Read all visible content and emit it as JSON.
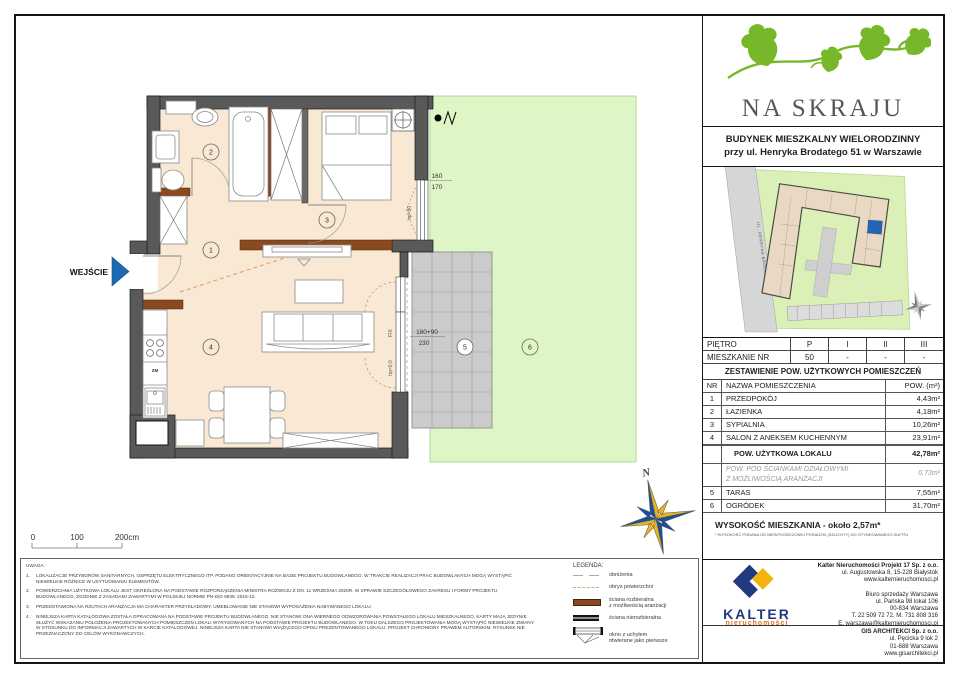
{
  "header": {
    "project_name": "NA SKRAJU",
    "building_line1": "BUDYNEK MIESZKALNY WIELORODZINNY",
    "building_line2": "przy ul. Henryka Brodatego 51 w Warszawie"
  },
  "site_plan": {
    "street_label": "UL. HENRYKA BRODATEGO"
  },
  "floor_table": {
    "floor_label": "PIĘTRO",
    "apartment_label": "MIESZKANIE NR",
    "columns": [
      "P",
      "I",
      "II",
      "III"
    ],
    "values": [
      "50",
      "-",
      "-",
      "-"
    ]
  },
  "area_table": {
    "title": "ZESTAWIENIE POW. UŻYTKOWYCH POMIESZCZEŃ",
    "col_nr": "NR",
    "col_name": "NAZWA POMIESZCZENIA",
    "col_area": "POW. (m²)",
    "rooms": [
      {
        "nr": "1",
        "name": "PRZEDPOKÓJ",
        "area": "4,43m²"
      },
      {
        "nr": "2",
        "name": "ŁAZIENKA",
        "area": "4,18m²"
      },
      {
        "nr": "3",
        "name": "SYPIALNIA",
        "area": "10,26m²"
      },
      {
        "nr": "4",
        "name": "SALON Z ANEKSEM KUCHENNYM",
        "area": "23,91m²"
      }
    ],
    "total_label": "POW. UŻYTKOWA LOKALU",
    "total_area": "42,78m²",
    "partition_line1": "POW. POD ŚCIANKAMI DZIAŁOWYMI",
    "partition_line2": "Z MOŻLIWOŚCIĄ ARANŻACJI",
    "partition_area": "0,73m²",
    "outdoor": [
      {
        "nr": "5",
        "name": "TARAS",
        "area": "7,55m²"
      },
      {
        "nr": "6",
        "name": "OGRÓDEK",
        "area": "31,70m²"
      }
    ],
    "height_label": "WYSOKOŚĆ MIESZKANIA - około 2,57m*",
    "height_footnote": "* WYSOKOŚĆ PODANA OD NIEWYKOŃCZONEJ POSADZKI (SZLICHTY) DO OTYNKOWANEGO SUFITU"
  },
  "plan": {
    "entrance_label": "WEJŚCIE",
    "north_label": "N",
    "room_numbers": [
      "1",
      "2",
      "3",
      "4",
      "5",
      "6"
    ],
    "window_dim1_top": "160",
    "window_dim1_bottom": "170",
    "window_dim2_top": "180+90",
    "window_dim2_bottom": "230",
    "fix_label": "FIX",
    "hp0_label": "hp=0,0",
    "hp80_label": "hp=80",
    "zm_label": "ZM",
    "scale": {
      "t0": "0",
      "t100": "100",
      "t200": "200cm"
    },
    "colors": {
      "wall": "#595959",
      "floor": "#f9e8d3",
      "partition_wall": "#8a4a1f",
      "garden": "#def5c5",
      "terrace": "#cbcbcb",
      "entrance_arrow": "#1e6ab2",
      "brand_green": "#76b82a",
      "kalter_navy": "#20397f",
      "kalter_yellow": "#f3b211"
    }
  },
  "legend": {
    "title": "LEGENDA:",
    "items": [
      {
        "label": "obniżenia",
        "label2": ""
      },
      {
        "label": "obrys powierzchni",
        "label2": ""
      },
      {
        "label": "ściana rozbieralna",
        "label2": "z możliwością aranżacji"
      },
      {
        "label": "ściana nierozbieralna",
        "label2": ""
      },
      {
        "label": "okno z uchyłem",
        "label2": "otwierane jako pierwsze"
      }
    ]
  },
  "notes": {
    "title": "UWAGA:",
    "items": [
      {
        "n": "1.",
        "text": "LOKALIZACJE PRZYBORÓW SANITARNYCH, OSPRZĘTU ELEKTRYCZNEGO ITP. PODANO ORIENTACYJNIE NA BAZIE PROJEKTU BUDOWLANEGO. W TRAKCIE REALIZACJI PRAC BUDOWLANYCH MOGĄ WYSTĄPIĆ NIEWIELKIE RÓŻNICE W USYTUOWANIU ELEMENTÓW."
      },
      {
        "n": "2.",
        "text": "POWIERZCHNIA UŻYTKOWA LOKALU JEST OKREŚLONA NA PODSTAWIE ROZPORZĄDZENIA MINISTRA ROZWOJU Z DN. 11 WRZEŚNIA 2020R. W SPRAWIE SZCZEGÓŁOWEGO ZAKRESU I FORMY PROJEKTU BUDOWLANEGO, ZGODNIE Z ZASADAMI ZAWARTYMI W POLSKIEJ NORMIE PN-ISO 9836: 2015-12."
      },
      {
        "n": "3.",
        "text": "PRZEDSTAWIONA NA RZUTACH ARANŻACJA MA CHARAKTER PRZYKŁADOWY. UMEBLOWANIE NIE STANOWI WYPOSAŻENIA NABYWANEGO LOKALU."
      },
      {
        "n": "4.",
        "text": "NINIEJSZA KARTA KATALOGOWA ZOSTAŁA OPRACOWANA NA PODSTAWIE PROJEKTU BUDOWLANEGO. NIE STANOWI ONA WIERNEGO ODWZOROWANIA POWSTAŁEGO LOKALU MIESZKALNEGO. KARTY MAJĄ JEDYNIE SŁUŻYĆ WSKAZANIU POŁOŻENIA PROJEKTOWANYCH POMIESZCZEŃ LOKALI WYRYSOWANYCH NA PODSTAWIE PROJEKTU BUDOWLANEGO. W TOKU DALSZEGO PROJEKTOWANIA MOGĄ WYSTĄPIĆ NIEWIELKIE ZMIANY W STOSUNKU DO INFORMACJI ZAWARTYCH W KARCIE KATALOGOWEJ. NINIEJSZA KARTA NIE STANOWI WIĄŻĄCEGO OPISU PREZENTOWANEGO LOKALU. PROJEKT CHRONIONY PRAWEM AUTORSKIM. RYSUNEK NIE PRZEZNACZONY DO CELÓW WYKONAWCZYCH."
      }
    ]
  },
  "footer": {
    "kalter_logo_text": "KALTER",
    "kalter_logo_sub": "nieruchomości",
    "kalter_company": "Kalter Nieruchomości Projekt 17 Sp. z o.o.",
    "kalter_address1": "ul. Augustowska 8, 15-228 Białystok",
    "kalter_www": "www.kalternieruchomosci.pl",
    "office_name": "Biuro sprzedaży Warszawa",
    "office_address1": "ul. Pańska 98 lokal 106",
    "office_address2": "00-834 Warszawa",
    "office_phone": "T. 22 509 72 72. M. 731 808 316",
    "office_email": "E. warszawa@kalternieruchomosci.pl",
    "gis_company": "GIS ARCHITEKCI Sp. z o.o.",
    "gis_address1": "ul. Pęcicka 9 lok 2",
    "gis_address2": "01-688 Warszawa",
    "gis_www": "www.gisarchitekci.pl"
  }
}
